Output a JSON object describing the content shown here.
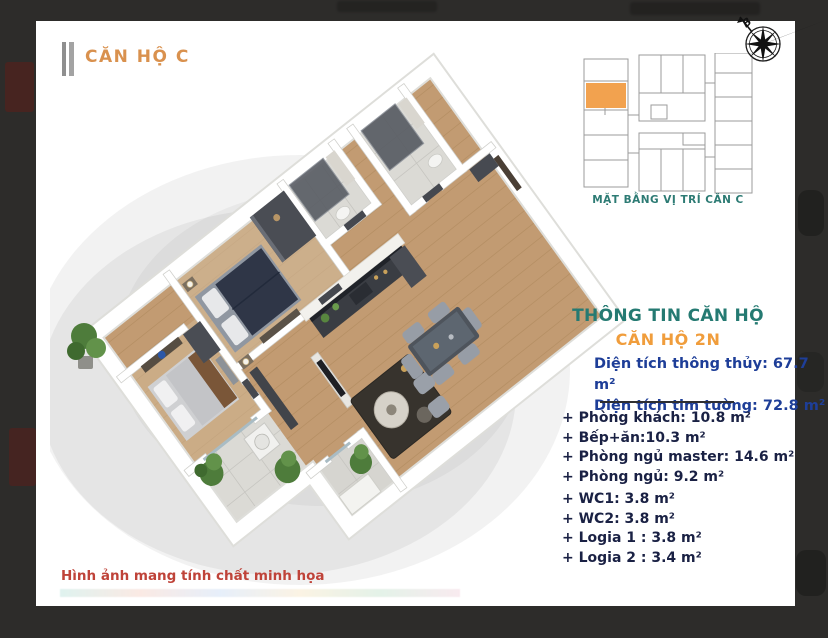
{
  "card": {
    "title": "CĂN HỘ C",
    "disclaimer": "Hình ảnh mang tính chất minh họa"
  },
  "location_map": {
    "caption": "MẶT BẰNG VỊ TRÍ CĂN C",
    "compass_label": "B",
    "highlight_color": "#f2a24f"
  },
  "info_panel": {
    "heading": "THÔNG TIN CĂN HỘ",
    "subheading": "CĂN HỘ 2N",
    "areas": [
      "Diện tích thông thủy: 67.7 m²",
      "Diện tích tim tường: 72.8 m²"
    ],
    "rooms": [
      "+ Phòng khách: 10.8 m²",
      "+ Bếp+ăn:10.3 m²",
      "+ Phòng ngủ master: 14.6 m²",
      "+ Phòng ngủ: 9.2 m²",
      "+ WC1: 3.8 m²",
      "+ WC2: 3.8 m²",
      "+ Logia 1 : 3.8 m²",
      "+ Logia 2 : 3.4 m²"
    ]
  },
  "colors": {
    "accent_orange": "#f09d3c",
    "teal": "#257a72",
    "blue": "#1e3e98",
    "navy": "#1a2144",
    "red": "#bf4339",
    "background": "#2d2c2a"
  }
}
